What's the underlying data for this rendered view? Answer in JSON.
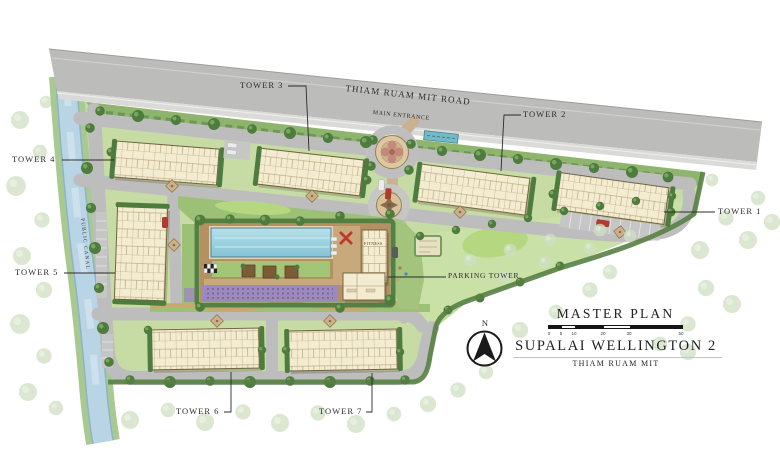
{
  "map": {
    "road_label": "THIAM RUAM MIT ROAD",
    "main_entrance_label": "MAIN ENTRANCE",
    "canal_label": "PUBLIC CANAL",
    "fitness_label": "FITNESS",
    "parking_tower_label": "PARKING TOWER",
    "towers": [
      {
        "label": "TOWER 1"
      },
      {
        "label": "TOWER 2"
      },
      {
        "label": "TOWER 3"
      },
      {
        "label": "TOWER 4"
      },
      {
        "label": "TOWER 5"
      },
      {
        "label": "TOWER 6"
      },
      {
        "label": "TOWER 7"
      }
    ]
  },
  "legend": {
    "title": "MASTER PLAN",
    "project_name": "SUPALAI WELLINGTON 2",
    "project_location": "THIAM RUAM MIT",
    "north_label": "N",
    "scale_ticks": [
      "0",
      "5",
      "10",
      "20",
      "30",
      "50"
    ]
  },
  "colors": {
    "road_gray": "#bcbdbb",
    "canal_blue": "#b9d4e5",
    "building_cream": "#f4ecd1",
    "pool_blue": "#9ed2df",
    "site_green": "#c7dca4",
    "label_ink": "#2b2b2b"
  }
}
